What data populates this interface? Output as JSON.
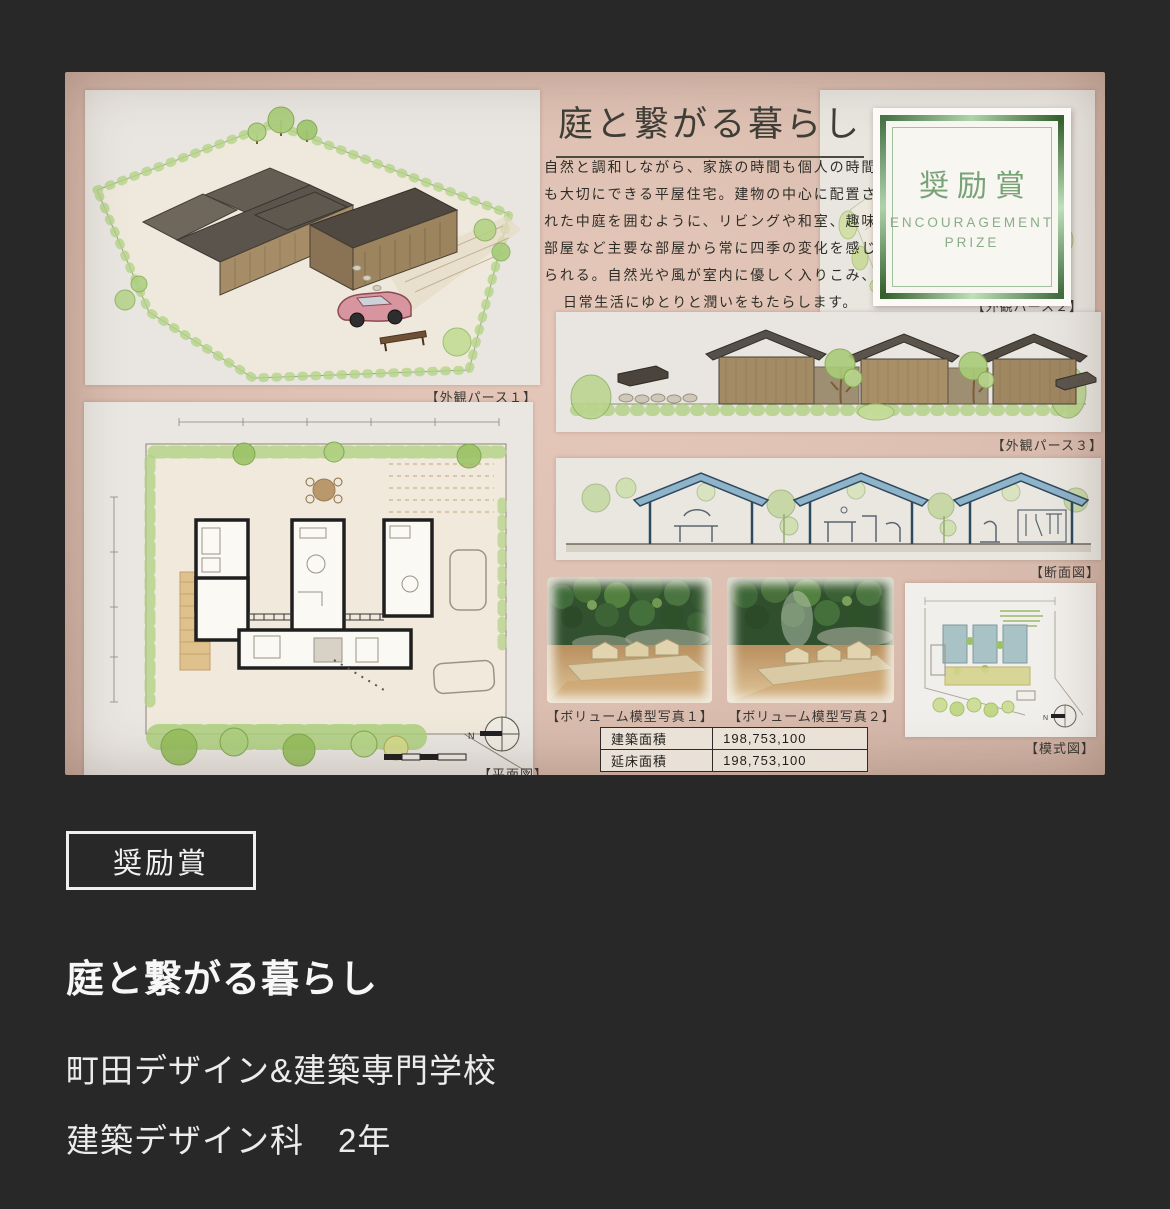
{
  "poster": {
    "title": "庭と繋がる暮らし",
    "description": "自然と調和しながら、家族の時間も個人の時間も大切にできる平屋住宅。建物の中心に配置された中庭を囲むように、リビングや和室、趣味部屋など主要な部屋から常に四季の変化を感じられる。自然光や風が室内に優しく入りこみ、日常生活にゆとりと潤いをもたらします。",
    "labels": {
      "perspective1": "【外観パース１】",
      "perspective2": "【外観パース２】",
      "perspective3": "【外観パース３】",
      "section": "【断面図】",
      "floor_plan": "【平面図】",
      "schematic": "【模式図】",
      "model_photo1": "【ボリューム模型写真１】",
      "model_photo2": "【ボリューム模型写真２】"
    },
    "award_badge": {
      "title": "奨励賞",
      "subtitle_line1": "ENCOURAGEMENT",
      "subtitle_line2": "PRIZE"
    },
    "area_table": {
      "rows": [
        {
          "label": "建築面積",
          "value": "198,753,100"
        },
        {
          "label": "延床面積",
          "value": "198,753,100"
        }
      ]
    },
    "compass_label": "N"
  },
  "entry": {
    "award": "奨励賞",
    "title": "庭と繋がる暮らし",
    "school": "町田デザイン&建築専門学校",
    "grade": "建築デザイン科　2年"
  },
  "colors": {
    "page_background": "#282828",
    "poster_pink": "#dcbfb1",
    "badge_green": "#79a277",
    "text_white": "#f2f2f2"
  }
}
